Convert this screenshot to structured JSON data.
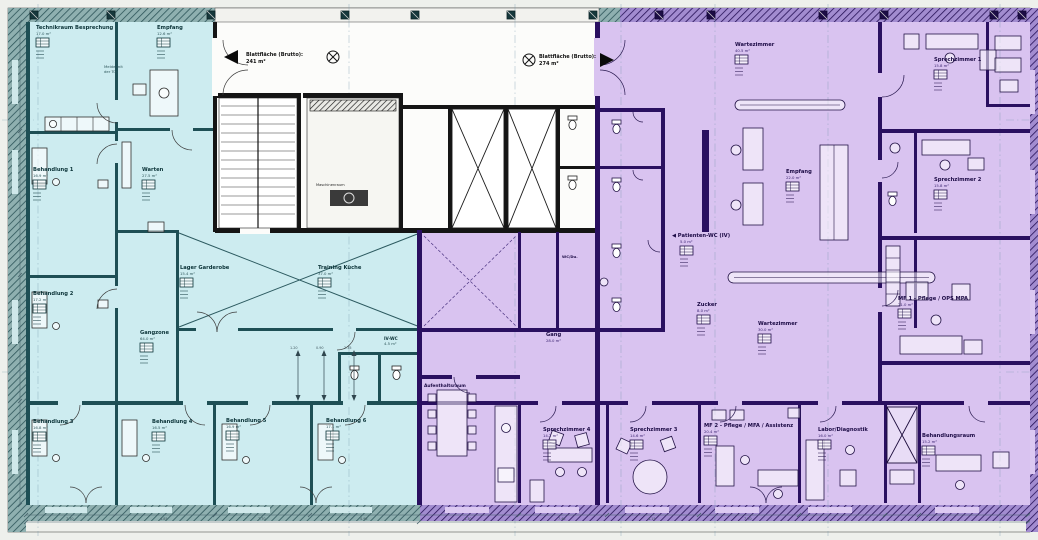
{
  "colors": {
    "cyan_fill": "#cdecf0",
    "cyan_wall": "#1e4f55",
    "purple_fill": "#d9c3f0",
    "purple_wall": "#2a1060",
    "core_wall": "#151515",
    "band_teal": "#4a7275",
    "band_purple": "#3b2171"
  },
  "annotations": {
    "sheet_area_left_label": "Blattfläche (Brutto):",
    "sheet_area_left_value": "241 m²",
    "sheet_area_right_label": "Blattfläche (Brutto):",
    "sheet_area_right_value": "274 m²",
    "door_note_line1": "Melde mit",
    "door_note_line2": "der Tür"
  },
  "rooms": {
    "technik": {
      "label": "Technikraum Besprechung",
      "area": "17.0 m²"
    },
    "empfang_links": {
      "label": "Empfang",
      "area": "12.6 m²"
    },
    "behandlung1": {
      "label": "Behandlung 1",
      "area": "16.9 m²"
    },
    "behandlung2": {
      "label": "Behandlung 2",
      "area": "17.2 m²"
    },
    "behandlung3": {
      "label": "Behandlung 3",
      "area": "16.8 m²"
    },
    "behandlung4": {
      "label": "Behandlung 4",
      "area": "16.5 m²"
    },
    "behandlung5": {
      "label": "Behandlung 5",
      "area": "16.9 m²"
    },
    "behandlung6": {
      "label": "Behandlung 6",
      "area": "17.1 m²"
    },
    "warten": {
      "label": "Warten",
      "area": "27.5 m²"
    },
    "gangzone": {
      "label": "Gangzone",
      "area": "64.0 m²"
    },
    "lager": {
      "label": "Lager Garderobe",
      "area": "15.4 m²"
    },
    "training_kueche": {
      "label": "Training Küche",
      "area": "37.0 m²"
    },
    "iv_wc": {
      "label": "IV-WC",
      "area": "4.5 m²"
    },
    "maschinenraum": {
      "label": "Maschinenraum",
      "area": ""
    },
    "wc_du": {
      "label": "WC/Du.",
      "area": ""
    },
    "wartezimmer1": {
      "label": "Wartezimmer",
      "area": "40.5 m²"
    },
    "empfang_rechts": {
      "label": "Empfang",
      "area": "22.0 m²"
    },
    "patienten_wc": {
      "label": "◀ Patienten-WC (IV)",
      "area": "5.0 m²"
    },
    "zucker": {
      "label": "Zucker",
      "area": "8.0 m²"
    },
    "wartezimmer2": {
      "label": "Wartezimmer",
      "area": "30.0 m²"
    },
    "sprechzimmer1": {
      "label": "Sprechzimmer 1",
      "area": "15.8 m²"
    },
    "sprechzimmer2": {
      "label": "Sprechzimmer 2",
      "area": "15.8 m²"
    },
    "mf1": {
      "label": "MF 1 - Pflege / OPS MPA",
      "area": "21.0 m²"
    },
    "gang": {
      "label": "Gang",
      "area": "28.0 m²"
    },
    "aufenthalt": {
      "label": "Aufenthaltsraum",
      "area": "18.5 m²"
    },
    "sprechzimmer3": {
      "label": "Sprechzimmer 3",
      "area": "14.6 m²"
    },
    "sprechzimmer4": {
      "label": "Sprechzimmer 4",
      "area": "14.2 m²"
    },
    "mf2": {
      "label": "MF 2 - Pflege / MFA / Assistenz",
      "area": "20.4 m²"
    },
    "labor": {
      "label": "Labor/Diagnostik",
      "area": "16.0 m²"
    },
    "behandlungsraum": {
      "label": "Behandlungsraum",
      "area": "15.2 m²"
    }
  },
  "dimensions": {
    "bottom": [
      "7.70",
      "4.85",
      "7.70",
      "4.95",
      "4.30",
      "7.45",
      "4.15",
      "7.70"
    ],
    "inner": [
      "1.20",
      "0.90",
      "2.35"
    ]
  }
}
